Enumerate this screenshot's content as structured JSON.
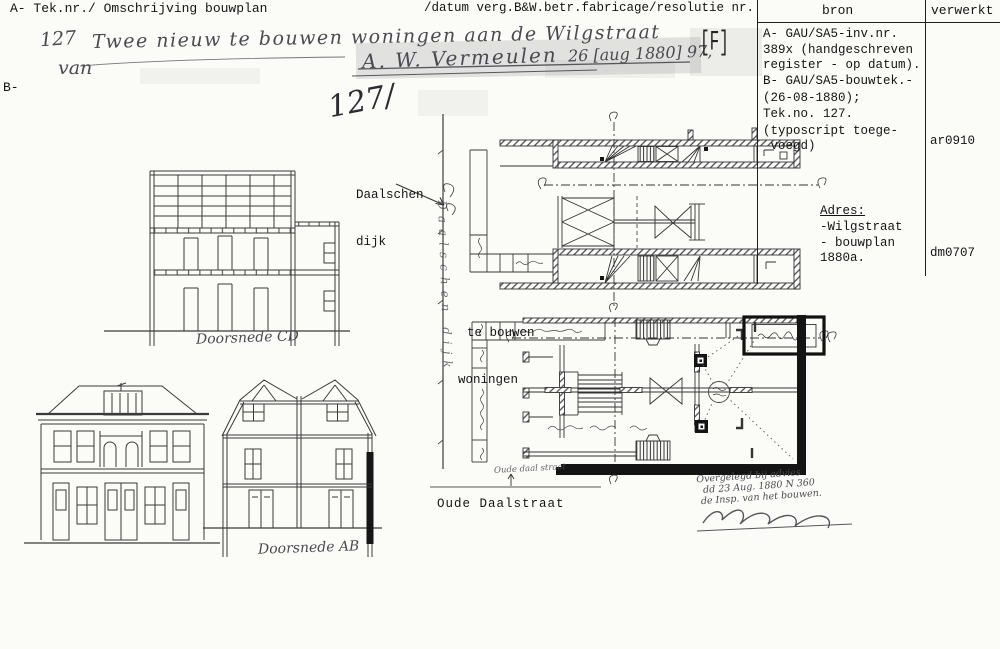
{
  "header": {
    "left": "A- Tek.nr./ Omschrijving bouwplan",
    "right": "/datum verg.B&W.betr.fabricage/resolutie nr.",
    "b_label": "B-"
  },
  "table": {
    "bron_header": "bron",
    "verwerkt_header": "verwerkt",
    "bron_lines": [
      "A- GAU/SA5-inv.nr.",
      "389x (handgeschreven",
      "register - op datum).",
      "B- GAU/SA5-bouwtek.-",
      "(26-08-1880);",
      "Tek.no. 127."
    ],
    "note_line1": "(typoscript toege-",
    "note_line2": " voegd)",
    "adres_header": "Adres:",
    "adres_lines": [
      "-Wilgstraat",
      "- bouwplan",
      "1880a."
    ],
    "verwerkt_code_a": "ar0910",
    "verwerkt_code_b": "dm0707"
  },
  "handwriting": {
    "number": "127",
    "description": "Twee nieuw te bouwen woningen aan de Wilgstraat",
    "van": "van",
    "name": "A. W. Vermeulen",
    "date": "26 [aug 1880] 97,",
    "marker": "[F]",
    "big_number": "127/",
    "canal_name": "Daalschen dijk",
    "street_scrawl": "Oude daal straat",
    "approval_line1": "Overgelegd bij advies",
    "approval_line2": "dd 23 Aug. 1880 N 360",
    "approval_line3": "de Insp. van het bouwen.",
    "caption_section_cd": "Doorsnede CD",
    "caption_section_ab": "Doorsnede AB"
  },
  "plan_labels": {
    "daalschen_line1": "Daalschen",
    "daalschen_line2": "dijk",
    "tebouwen_line1": "te bouwen",
    "tebouwen_line2": "woningen",
    "oude_daalstraat": "Oude Daalstraat"
  }
}
